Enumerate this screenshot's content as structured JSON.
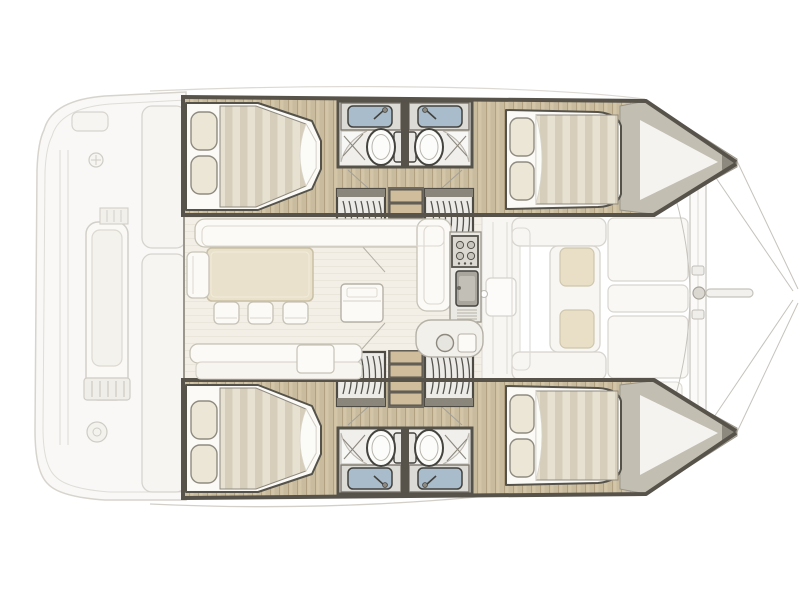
{
  "meta": {
    "title": "Catamaran interior layout plan",
    "description": "Top-down interior layout plan of a four-cabin, four-bathroom sailing catamaran, bow pointing right"
  },
  "layout": {
    "vessel_type": "catamaran",
    "view": "top-down",
    "bow_direction": "right",
    "hulls": 2,
    "cabins": 4,
    "bathrooms": 4
  },
  "colors": {
    "background": "#ffffff",
    "wall_dark": "#57534b",
    "wall_mid": "#8d897e",
    "wood_floor": "#d3c5a7",
    "wood_grain": "#b2a282",
    "salon_floor": "#f3efe6",
    "salon_stripe": "#5b5648",
    "mattress_light": "#e7e1d2",
    "mattress_dark": "#d6ceba",
    "pillow": "#ece6d6",
    "linen_white": "#fbfaf7",
    "furniture_outline": "#c6c2b6",
    "cushion_beige": "#e8dfc6",
    "sink_blue": "#a8bccb",
    "fixture_outline": "#45433e",
    "bow_deck_gray": "#c3beb2",
    "ghost_line": "#d7d4cd",
    "ghost_fill": "#f8f7f4",
    "steps_wood": "#cfbd9c"
  },
  "regions": {
    "aft_deck": {
      "label": "aft cockpit and stern platforms",
      "items": [
        "bench seat with cushion",
        "stern module",
        "transom steps",
        "deck winch",
        "deck hatch ring"
      ]
    },
    "salon": {
      "label": "salon and galley",
      "items": [
        "L-shaped settee",
        "dining table",
        "three stools",
        "side seat",
        "aft bench with cushion",
        "fridge cabinet",
        "four-burner stove",
        "galley sink with drainer",
        "counter with round sink",
        "sliding door to foredeck"
      ]
    },
    "upper_hull": {
      "label": "upper hull",
      "items": [
        "aft double berth with two pillows",
        "bathroom: sink, toilet, shower",
        "mirrored bathroom: sink, toilet, shower",
        "companionway steps",
        "wardrobe step lockers",
        "forward double berth with two pillows",
        "bow locker"
      ]
    },
    "lower_hull": {
      "label": "lower hull (mirror of upper hull)",
      "items": [
        "aft double berth with two pillows",
        "bathroom: sink, toilet, shower",
        "mirrored bathroom: sink, toilet, shower",
        "companionway steps",
        "wardrobe step lockers",
        "forward double berth with two pillows",
        "bow locker"
      ]
    },
    "foredeck": {
      "label": "foredeck and bows",
      "items": [
        "forward cockpit benches",
        "two sunpad cushions",
        "rigid deck panels",
        "forward crossbeam",
        "bowsprit",
        "forestay rigging lines"
      ]
    }
  }
}
